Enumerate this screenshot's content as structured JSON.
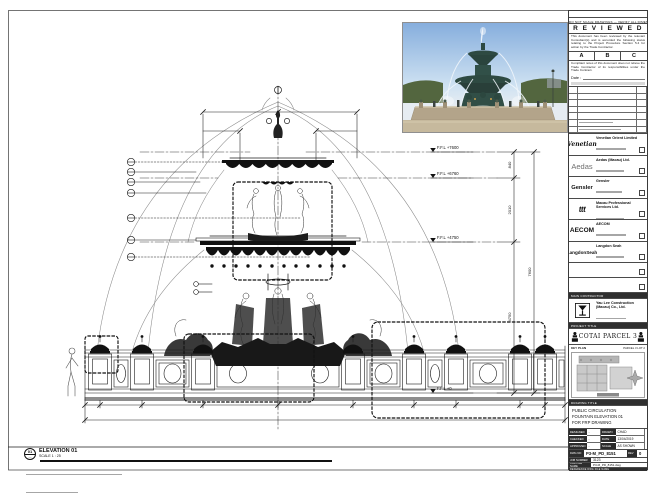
{
  "colors": {
    "line": "#1b1b1b",
    "photo_sky": "#9fc0e4",
    "photo_bronze": "#2e4a42",
    "photo_stone": "#b3a48a"
  },
  "stamp": {
    "top_note": "DO NOT SCALE DRAWINGS — VERIFY ALL DIMENSIONS ON SITE",
    "title": "R E V I E W E D",
    "para1": "This document has been reviewed by the relevant Consultant(s) and is accorded the following status relating to the Project Procedure Section 5.4 for action by the Trade Contractor.",
    "statuses": [
      "A",
      "B",
      "C"
    ],
    "para2": "Compliant notes of this document does not relieve the Trade Contractor of its responsibilities under the Trade Contract.",
    "date_label": "Date :"
  },
  "consultants": [
    {
      "logo": "Venetian",
      "org": "Venetian Orient Limited"
    },
    {
      "logo": "Aedas",
      "org": "Aedas (Macau) Ltd."
    },
    {
      "logo": "Gensler",
      "org": "Gensler"
    },
    {
      "logo": "ttt",
      "org": "Macau Professional Services Ltd."
    },
    {
      "logo": "AECOM",
      "org": "AECOM"
    },
    {
      "logo": "LangdonSeah",
      "org": "Langdon Seah"
    }
  ],
  "contractor": {
    "bar": "MAIN CONTRACTOR",
    "org": "Yau Lee Construction (Macau) Co., Ltd."
  },
  "project": {
    "bar": "PROJECT TITLE",
    "title": "COTAI PARCEL 3"
  },
  "key_plan": {
    "label": "KEY PLAN",
    "sub": "PARCEL 3 LOT 2"
  },
  "drawing_title": {
    "bar": "DRAWING TITLE",
    "lines": [
      "PUBLIC CIRCULATION",
      "FOUNTAIN ELEVATION 01",
      "FOR FRP DRAWING"
    ]
  },
  "fields": {
    "designed_label": "DESIGNED",
    "designed": "-",
    "drawn_label": "DRAWN",
    "drawn": "CHAD",
    "checked_label": "CHECKED",
    "checked": "-",
    "date_label": "DATE",
    "date": "13/04/2019",
    "approved_label": "APPROVED",
    "approved": "-",
    "scale_label": "SCALE",
    "scale": "AS SHOWN",
    "dwg_label": "DWG NO",
    "dwg_no": "P3-M_PD_8151",
    "rev_label": "REV",
    "rev": "0",
    "job_label": "JOB NUMBER",
    "job": "3123",
    "cad_label": "CAD FILE NAME",
    "cad": "P3-M_PD_8151.dwg",
    "ref_label": "REFERENCE DWG FILE NAME"
  },
  "elevation_label": {
    "bubble_top": "01",
    "bubble_bottom": "—",
    "title": "ELEVATION 01",
    "scale": "SCALE 1 : 25"
  },
  "levels": [
    "F.F.L +7600",
    "F.F.L +6760",
    "F.F.L +4750",
    "F.F.L +0"
  ],
  "dims": [
    "840",
    "2010",
    "4750",
    "7600"
  ]
}
